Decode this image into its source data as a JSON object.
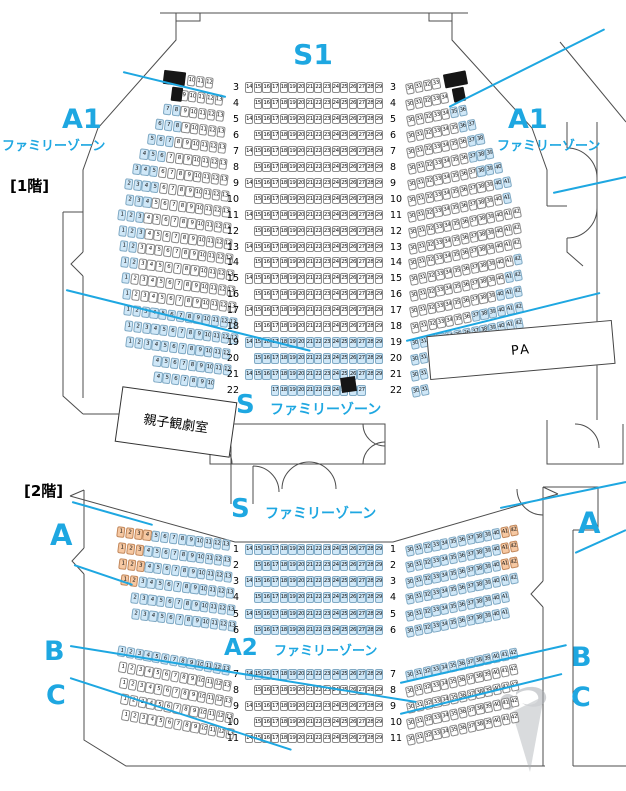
{
  "colors": {
    "accent_blue": "#1ea7e1",
    "family_zone_fill": "#cfe7f7",
    "orange_zone_fill": "#f6c8a2",
    "seat_outline": "#8a8a8a",
    "speaker_block": "#161616"
  },
  "floor1": {
    "floor_label": "[1階]",
    "stage_zone": "S1",
    "a1_left": {
      "name": "A1",
      "sub": "ファミリーゾーン"
    },
    "a1_right": {
      "name": "A1",
      "sub": "ファミリーゾーン"
    },
    "s_zone": {
      "name": "S",
      "sub": "ファミリーゾーン"
    },
    "room_label": "親子観劇室",
    "pa_label": "PA",
    "rows": [
      {
        "n": 3,
        "L": {
          "s": 10,
          "e": 12,
          "blk": [
            [
              7.2,
              2.6
            ]
          ]
        },
        "C": {
          "s": 14,
          "e": 29
        },
        "R": {
          "s": 30,
          "e": 33,
          "blk": [
            [
              34.4,
              2.6
            ]
          ]
        }
      },
      {
        "n": 4,
        "L": {
          "s": 9,
          "e": 13,
          "blk": [
            [
              8.0,
              1.3
            ]
          ]
        },
        "C": {
          "s": 15,
          "e": 29
        },
        "R": {
          "s": 30,
          "e": 34,
          "blk": [
            [
              35.4,
              1.4
            ]
          ]
        }
      },
      {
        "n": 5,
        "L": {
          "s": 7,
          "e": 13,
          "hl": [
            [
              7,
              8,
              "b"
            ]
          ]
        },
        "C": {
          "s": 14,
          "e": 29
        },
        "R": {
          "s": 30,
          "e": 36,
          "hl": [
            [
              35,
              36,
              "b"
            ]
          ]
        }
      },
      {
        "n": 6,
        "L": {
          "s": 6,
          "e": 13,
          "hl": [
            [
              6,
              8,
              "b"
            ]
          ]
        },
        "C": {
          "s": 15,
          "e": 29
        },
        "R": {
          "s": 30,
          "e": 37,
          "hl": [
            [
              36,
              37,
              "b"
            ]
          ]
        }
      },
      {
        "n": 7,
        "L": {
          "s": 5,
          "e": 13,
          "hl": [
            [
              5,
              7,
              "b"
            ]
          ]
        },
        "C": {
          "s": 14,
          "e": 29
        },
        "R": {
          "s": 30,
          "e": 38,
          "hl": [
            [
              37,
              38,
              "b"
            ]
          ]
        }
      },
      {
        "n": 8,
        "L": {
          "s": 4,
          "e": 13,
          "hl": [
            [
              4,
              6,
              "b"
            ]
          ]
        },
        "C": {
          "s": 15,
          "e": 29
        },
        "R": {
          "s": 30,
          "e": 39,
          "hl": [
            [
              37,
              39,
              "b"
            ]
          ]
        }
      },
      {
        "n": 9,
        "L": {
          "s": 3,
          "e": 13,
          "hl": [
            [
              3,
              5,
              "b"
            ]
          ]
        },
        "C": {
          "s": 14,
          "e": 29
        },
        "R": {
          "s": 30,
          "e": 40,
          "hl": [
            [
              38,
              40,
              "b"
            ]
          ]
        }
      },
      {
        "n": 10,
        "L": {
          "s": 2,
          "e": 13,
          "hl": [
            [
              2,
              5,
              "b"
            ]
          ]
        },
        "C": {
          "s": 15,
          "e": 29
        },
        "R": {
          "s": 30,
          "e": 41,
          "hl": [
            [
              40,
              41,
              "b"
            ]
          ]
        }
      },
      {
        "n": 11,
        "L": {
          "s": 2,
          "e": 13,
          "hl": [
            [
              2,
              4,
              "b"
            ]
          ]
        },
        "C": {
          "s": 14,
          "e": 29
        },
        "R": {
          "s": 30,
          "e": 41,
          "hl": [
            [
              41,
              41,
              "b"
            ]
          ]
        }
      },
      {
        "n": 12,
        "L": {
          "s": 1,
          "e": 13,
          "hl": [
            [
              1,
              3,
              "b"
            ]
          ]
        },
        "C": {
          "s": 15,
          "e": 29
        },
        "R": {
          "s": 30,
          "e": 42
        }
      },
      {
        "n": 13,
        "L": {
          "s": 1,
          "e": 13,
          "hl": [
            [
              1,
              3,
              "b"
            ]
          ]
        },
        "C": {
          "s": 14,
          "e": 29
        },
        "R": {
          "s": 30,
          "e": 42
        }
      },
      {
        "n": 14,
        "L": {
          "s": 1,
          "e": 13,
          "hl": [
            [
              1,
              2,
              "b"
            ]
          ]
        },
        "C": {
          "s": 15,
          "e": 29
        },
        "R": {
          "s": 30,
          "e": 42
        }
      },
      {
        "n": 15,
        "L": {
          "s": 1,
          "e": 13,
          "hl": [
            [
              1,
              2,
              "b"
            ]
          ]
        },
        "C": {
          "s": 14,
          "e": 29
        },
        "R": {
          "s": 30,
          "e": 42,
          "hl": [
            [
              42,
              42,
              "b"
            ]
          ]
        }
      },
      {
        "n": 16,
        "L": {
          "s": 1,
          "e": 13,
          "hl": [
            [
              1,
              1,
              "b"
            ]
          ]
        },
        "C": {
          "s": 15,
          "e": 29
        },
        "R": {
          "s": 30,
          "e": 42,
          "hl": [
            [
              41,
              42,
              "b"
            ]
          ]
        }
      },
      {
        "n": 17,
        "L": {
          "s": 1,
          "e": 13,
          "hl": [
            [
              1,
              1,
              "b"
            ]
          ]
        },
        "C": {
          "s": 14,
          "e": 29
        },
        "R": {
          "s": 30,
          "e": 42,
          "hl": [
            [
              40,
              42,
              "b"
            ]
          ]
        }
      },
      {
        "n": 18,
        "L": {
          "s": 1,
          "e": 13,
          "hl": [
            [
              1,
              13,
              "b"
            ]
          ]
        },
        "C": {
          "s": 15,
          "e": 29
        },
        "R": {
          "s": 30,
          "e": 42,
          "hl": [
            [
              37,
              42,
              "b"
            ]
          ]
        }
      },
      {
        "n": 19,
        "L": {
          "s": 1,
          "e": 13,
          "hl": [
            [
              1,
              13,
              "b"
            ]
          ]
        },
        "C": {
          "s": 14,
          "e": 29,
          "hl": [
            [
              14,
              29,
              "b"
            ]
          ]
        },
        "R": {
          "s": 30,
          "e": 42,
          "hl": [
            [
              30,
              42,
              "b"
            ]
          ]
        }
      },
      {
        "n": 20,
        "L": {
          "s": 1,
          "e": 12,
          "hl": [
            [
              1,
              12,
              "b"
            ]
          ]
        },
        "C": {
          "s": 15,
          "e": 29,
          "hl": [
            [
              15,
              29,
              "b"
            ]
          ]
        },
        "R": {
          "s": 30,
          "e": 31,
          "hl": [
            [
              30,
              31,
              "b"
            ]
          ]
        }
      },
      {
        "n": 21,
        "L": {
          "s": 4,
          "e": 12,
          "hl": [
            [
              4,
              12,
              "b"
            ]
          ]
        },
        "C": {
          "s": 14,
          "e": 29,
          "hl": [
            [
              14,
              29,
              "b"
            ]
          ]
        },
        "R": {
          "s": 30,
          "e": 31,
          "hl": [
            [
              30,
              31,
              "b"
            ]
          ]
        }
      },
      {
        "n": 22,
        "L": {
          "s": 4,
          "e": 10,
          "hl": [
            [
              4,
              10,
              "b"
            ]
          ]
        },
        "C": {
          "s": 17,
          "e": 27,
          "hl": [
            [
              17,
              27,
              "b"
            ]
          ]
        },
        "R": {
          "s": 30,
          "e": 31,
          "hl": [
            [
              30,
              31,
              "b"
            ]
          ]
        }
      }
    ]
  },
  "floor2": {
    "floor_label": "[2階]",
    "s_zone": {
      "name": "S",
      "sub": "ファミリーゾーン"
    },
    "a2_zone": {
      "name": "A2",
      "sub": "ファミリーゾーン"
    },
    "a_left": "A",
    "a_right": "A",
    "b_left": "B",
    "b_right": "B",
    "c_left": "C",
    "c_right": "C",
    "rows": [
      {
        "n": 1,
        "L": {
          "s": 1,
          "e": 13,
          "hl": [
            [
              1,
              4,
              "o"
            ],
            [
              5,
              13,
              "b"
            ]
          ]
        },
        "C": {
          "s": 14,
          "e": 29,
          "hl": [
            [
              14,
              29,
              "b"
            ]
          ]
        },
        "R": {
          "s": 30,
          "e": 42,
          "hl": [
            [
              30,
              40,
              "b"
            ],
            [
              41,
              42,
              "o"
            ]
          ]
        }
      },
      {
        "n": 2,
        "L": {
          "s": 1,
          "e": 13,
          "hl": [
            [
              1,
              3,
              "o"
            ],
            [
              4,
              13,
              "b"
            ]
          ]
        },
        "C": {
          "s": 15,
          "e": 29,
          "hl": [
            [
              15,
              29,
              "b"
            ]
          ]
        },
        "R": {
          "s": 30,
          "e": 42,
          "hl": [
            [
              30,
              40,
              "b"
            ],
            [
              41,
              42,
              "o"
            ]
          ]
        }
      },
      {
        "n": 3,
        "L": {
          "s": 1,
          "e": 13,
          "hl": [
            [
              1,
              3,
              "o"
            ],
            [
              4,
              13,
              "b"
            ]
          ]
        },
        "C": {
          "s": 14,
          "e": 29,
          "hl": [
            [
              14,
              29,
              "b"
            ]
          ]
        },
        "R": {
          "s": 30,
          "e": 42,
          "hl": [
            [
              30,
              40,
              "b"
            ],
            [
              41,
              42,
              "o"
            ]
          ]
        }
      },
      {
        "n": 4,
        "L": {
          "s": 1,
          "e": 13,
          "hl": [
            [
              1,
              2,
              "o"
            ],
            [
              3,
              13,
              "b"
            ]
          ]
        },
        "C": {
          "s": 15,
          "e": 29,
          "hl": [
            [
              15,
              29,
              "b"
            ]
          ]
        },
        "R": {
          "s": 30,
          "e": 42,
          "hl": [
            [
              30,
              42,
              "b"
            ]
          ]
        }
      },
      {
        "n": 5,
        "L": {
          "s": 2,
          "e": 13,
          "hl": [
            [
              2,
              13,
              "b"
            ]
          ]
        },
        "C": {
          "s": 14,
          "e": 29,
          "hl": [
            [
              14,
              29,
              "b"
            ]
          ]
        },
        "R": {
          "s": 30,
          "e": 41,
          "hl": [
            [
              30,
              41,
              "b"
            ]
          ]
        }
      },
      {
        "n": 6,
        "L": {
          "s": 2,
          "e": 13,
          "hl": [
            [
              2,
              13,
              "b"
            ]
          ]
        },
        "C": {
          "s": 15,
          "e": 29,
          "hl": [
            [
              15,
              29,
              "b"
            ]
          ]
        },
        "R": {
          "s": 30,
          "e": 41,
          "hl": [
            [
              30,
              41,
              "b"
            ]
          ]
        }
      },
      {
        "n": 7,
        "L": {
          "s": 1,
          "e": 13,
          "hl": [
            [
              1,
              13,
              "b"
            ]
          ]
        },
        "C": {
          "s": 14,
          "e": 29,
          "hl": [
            [
              14,
              29,
              "b"
            ]
          ]
        },
        "R": {
          "s": 30,
          "e": 42,
          "hl": [
            [
              30,
              42,
              "b"
            ]
          ]
        }
      },
      {
        "n": 8,
        "L": {
          "s": 1,
          "e": 13
        },
        "C": {
          "s": 15,
          "e": 29
        },
        "R": {
          "s": 30,
          "e": 42
        }
      },
      {
        "n": 9,
        "L": {
          "s": 1,
          "e": 13
        },
        "C": {
          "s": 14,
          "e": 29
        },
        "R": {
          "s": 30,
          "e": 42
        }
      },
      {
        "n": 10,
        "L": {
          "s": 1,
          "e": 13
        },
        "C": {
          "s": 15,
          "e": 29
        },
        "R": {
          "s": 30,
          "e": 42
        }
      },
      {
        "n": 11,
        "L": {
          "s": 1,
          "e": 13
        },
        "C": {
          "s": 14,
          "e": 29
        },
        "R": {
          "s": 30,
          "e": 42
        }
      }
    ]
  }
}
